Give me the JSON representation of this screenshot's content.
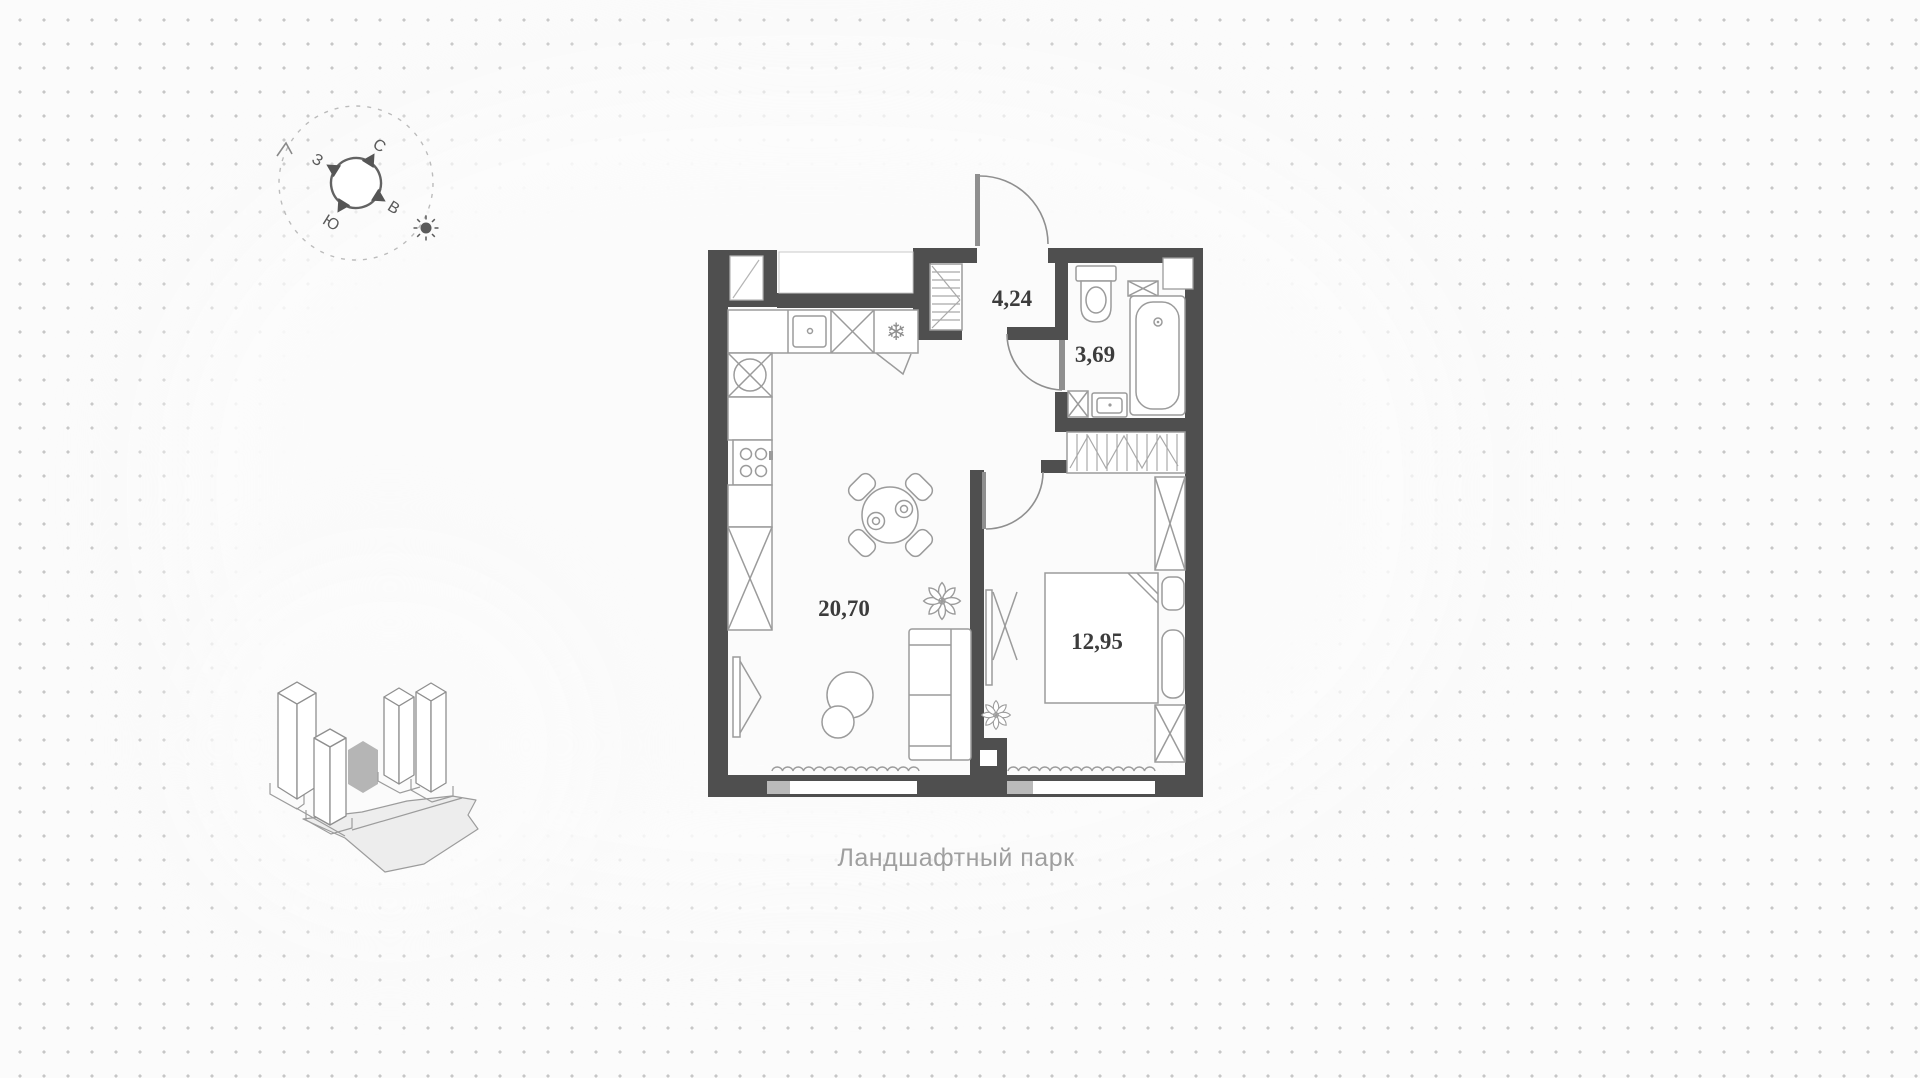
{
  "caption": "Ландшафтный парк",
  "rooms": {
    "hallway_area": "4,24",
    "bathroom_area": "3,69",
    "living_area": "20,70",
    "bedroom_area": "12,95"
  },
  "compass": {
    "north": "С",
    "east": "В",
    "south": "Ю",
    "west": "З"
  },
  "icons": [
    "compass-rose-icon",
    "sun-icon",
    "fridge-snowflake-icon",
    "plant-icon",
    "site-plan-icon"
  ],
  "colors": {
    "wall": "#4f4f4f",
    "furniture_stroke": "#9b9b9b",
    "room_label": "#3c3c3c",
    "caption": "#9f9f9f",
    "background_dots": "#c6c6c6",
    "highlighted_building": "#b5b5b5",
    "park_fill": "#ededed"
  }
}
